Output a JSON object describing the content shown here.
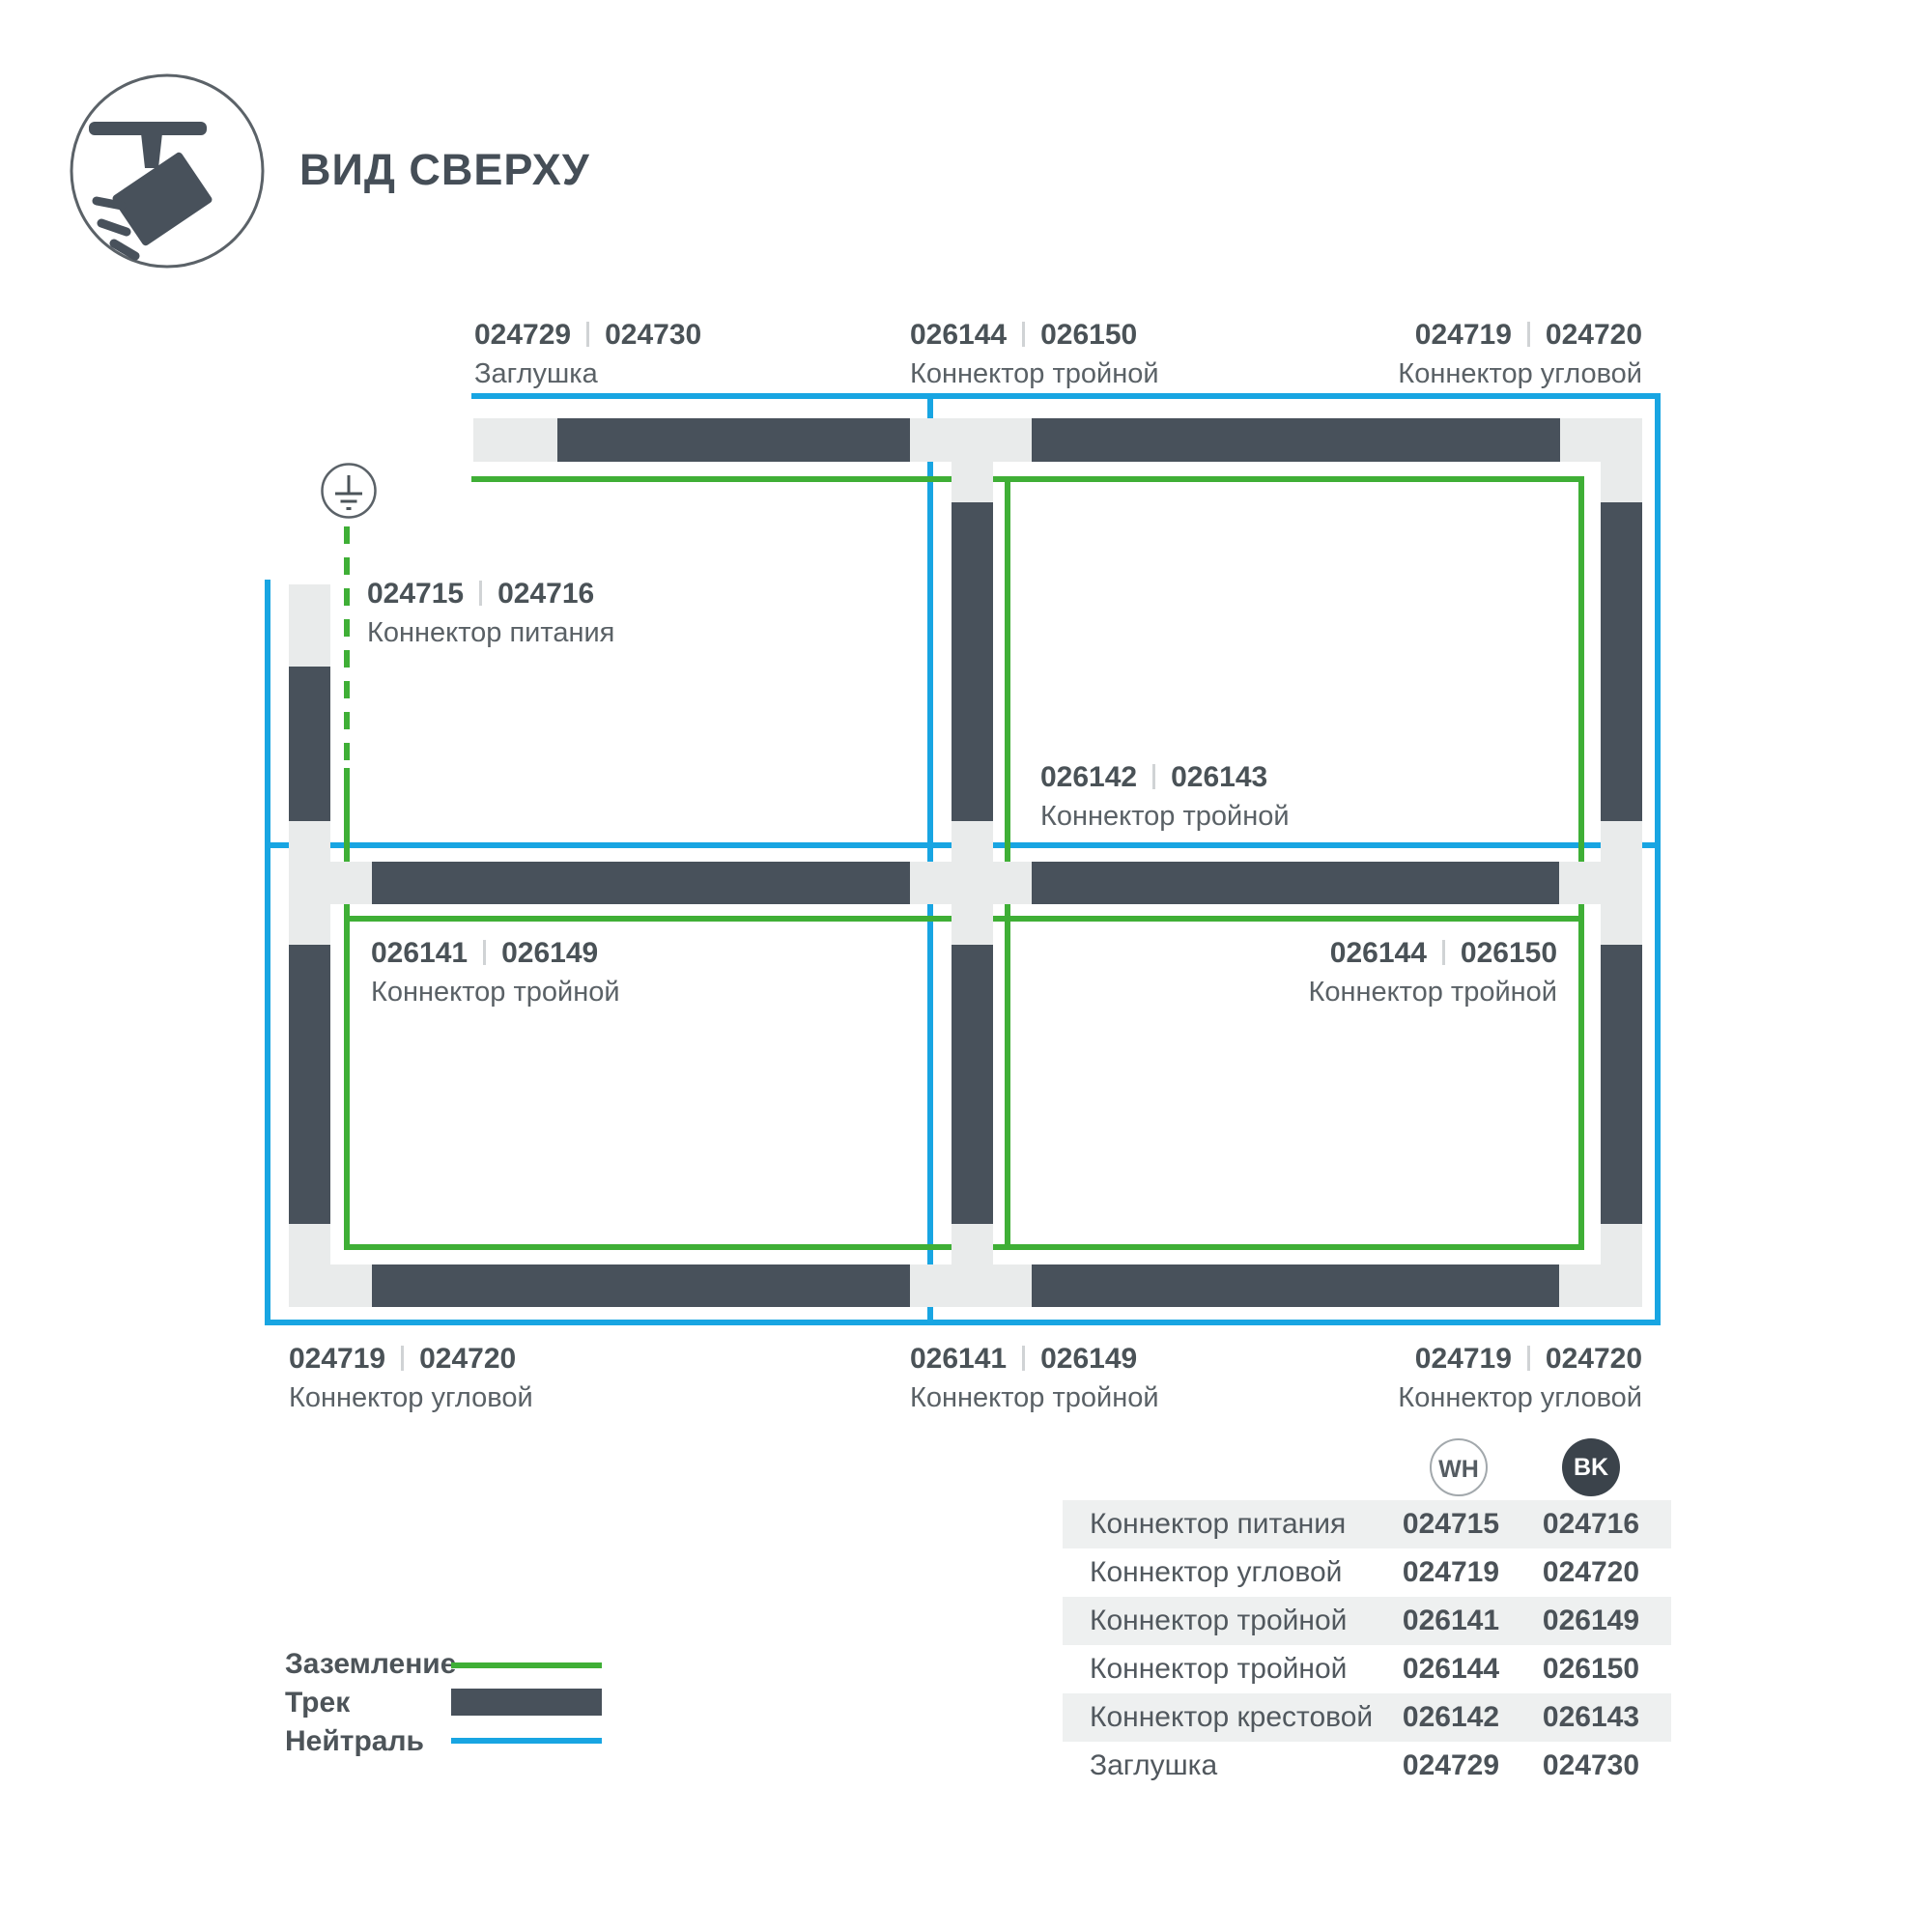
{
  "title": "ВИД СВЕРХУ",
  "colors": {
    "neutral_blue": "#18A5E2",
    "ground_green": "#3FAF36",
    "track_dark": "#48515B",
    "connector_light": "#E9EBEB"
  },
  "diagram": {
    "labels": [
      {
        "num1": "024729",
        "num2": "024730",
        "desc": "Заглушка"
      },
      {
        "num1": "026144",
        "num2": "026150",
        "desc": "Коннектор тройной"
      },
      {
        "num1": "024719",
        "num2": "024720",
        "desc": "Коннектор угловой"
      },
      {
        "num1": "024715",
        "num2": "024716",
        "desc": "Коннектор питания"
      },
      {
        "num1": "026142",
        "num2": "026143",
        "desc": "Коннектор тройной"
      },
      {
        "num1": "026141",
        "num2": "026149",
        "desc": "Коннектор тройной"
      },
      {
        "num1": "026144",
        "num2": "026150",
        "desc": "Коннектор тройной"
      },
      {
        "num1": "024719",
        "num2": "024720",
        "desc": "Коннектор угловой"
      },
      {
        "num1": "026141",
        "num2": "026149",
        "desc": "Коннектор тройной"
      },
      {
        "num1": "024719",
        "num2": "024720",
        "desc": "Коннектор угловой"
      }
    ]
  },
  "legend": [
    {
      "label": "Заземление",
      "swatch": "line-green"
    },
    {
      "label": "Трек",
      "swatch": "bar-dark"
    },
    {
      "label": "Нейтраль",
      "swatch": "line-blue"
    }
  ],
  "table": {
    "columns": [
      {
        "code": "WH"
      },
      {
        "code": "BK"
      }
    ],
    "rows": [
      {
        "name": "Коннектор питания",
        "wh": "024715",
        "bk": "024716"
      },
      {
        "name": "Коннектор угловой",
        "wh": "024719",
        "bk": "024720"
      },
      {
        "name": "Коннектор тройной",
        "wh": "026141",
        "bk": "026149"
      },
      {
        "name": "Коннектор тройной",
        "wh": "026144",
        "bk": "026150"
      },
      {
        "name": "Коннектор крестовой",
        "wh": "026142",
        "bk": "026143"
      },
      {
        "name": "Заглушка",
        "wh": "024729",
        "bk": "024730"
      }
    ]
  }
}
